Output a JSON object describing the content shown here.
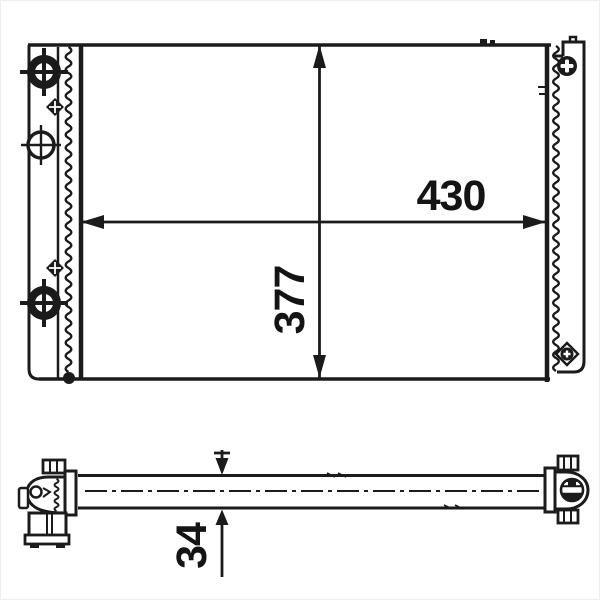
{
  "colors": {
    "ink": "#1b1b1b",
    "background": "#ffffff"
  },
  "drawing": {
    "kind": "radiator technical drawing, front view and side profile"
  },
  "dimensions": {
    "width": "430",
    "height": "377",
    "depth": "34"
  }
}
